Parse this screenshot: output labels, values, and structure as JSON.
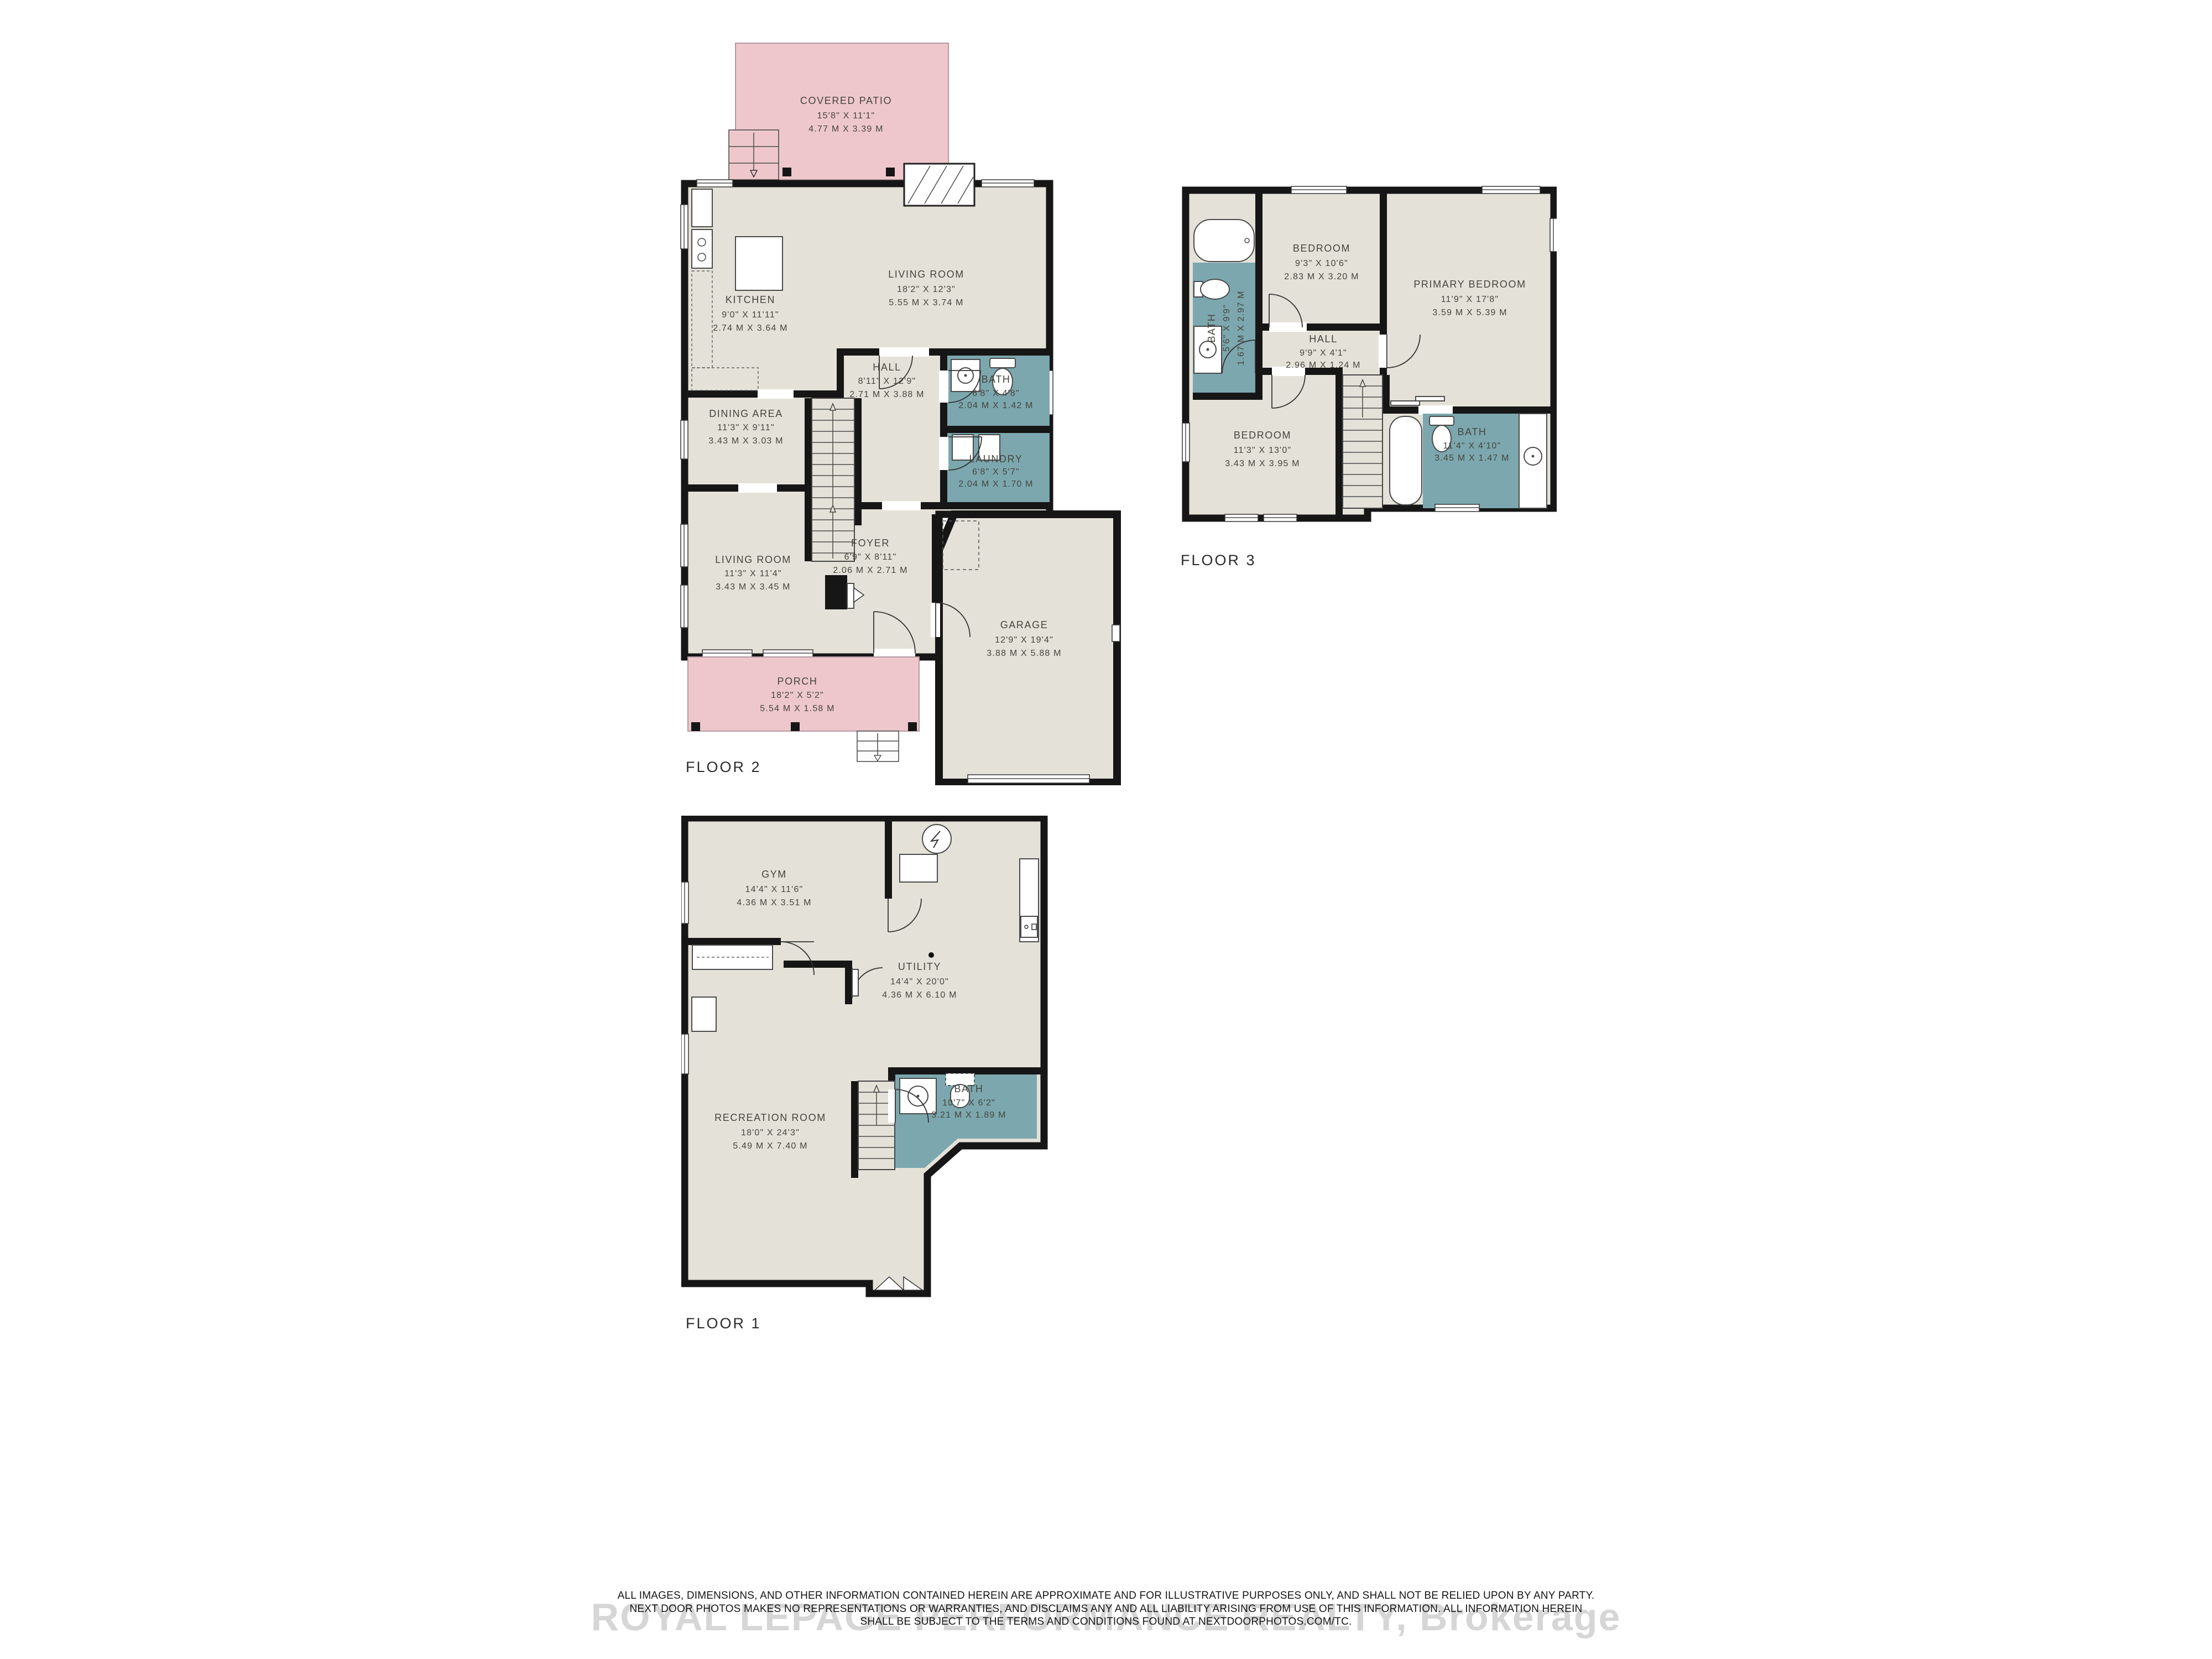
{
  "colors": {
    "room_fill": "#e4e2d8",
    "wet_fill": "#7ca7ae",
    "outdoor_fill": "#eec7cc",
    "wall": "#161616"
  },
  "floors": [
    {
      "label": "FLOOR 2",
      "rooms": [
        {
          "name": "COVERED PATIO",
          "ft": "15'8\" X 11'1\"",
          "m": "4.77 M X 3.39 M"
        },
        {
          "name": "KITCHEN",
          "ft": "9'0\" X 11'11\"",
          "m": "2.74 M X 3.64 M"
        },
        {
          "name": "LIVING ROOM",
          "ft": "18'2\" X 12'3\"",
          "m": "5.55 M X 3.74 M"
        },
        {
          "name": "HALL",
          "ft": "8'11\" X 12'9\"",
          "m": "2.71 M X 3.88 M"
        },
        {
          "name": "BATH",
          "ft": "6'8\" X 4'8\"",
          "m": "2.04 M X 1.42 M"
        },
        {
          "name": "DINING AREA",
          "ft": "11'3\" X 9'11\"",
          "m": "3.43 M X 3.03 M"
        },
        {
          "name": "LAUNDRY",
          "ft": "6'8\" X 5'7\"",
          "m": "2.04 M X 1.70 M"
        },
        {
          "name": "LIVING ROOM",
          "ft": "11'3\" X 11'4\"",
          "m": "3.43 M X 3.45 M"
        },
        {
          "name": "FOYER",
          "ft": "6'9\" X 8'11\"",
          "m": "2.06 M X 2.71 M"
        },
        {
          "name": "GARAGE",
          "ft": "12'9\" X 19'4\"",
          "m": "3.88 M X 5.88 M"
        },
        {
          "name": "PORCH",
          "ft": "18'2\" X 5'2\"",
          "m": "5.54 M X 1.58 M"
        }
      ]
    },
    {
      "label": "FLOOR 3",
      "rooms": [
        {
          "name": "BEDROOM",
          "ft": "9'3\" X 10'6\"",
          "m": "2.83 M X 3.20 M"
        },
        {
          "name": "PRIMARY BEDROOM",
          "ft": "11'9\" X 17'8\"",
          "m": "3.59 M X 5.39 M"
        },
        {
          "name": "BATH",
          "ft": "5'6\" X 9'9\"",
          "m": "1.67 M X 2.97 M"
        },
        {
          "name": "HALL",
          "ft": "9'9\" X 4'1\"",
          "m": "2.96 M X 1.24 M"
        },
        {
          "name": "BEDROOM",
          "ft": "11'3\" X 13'0\"",
          "m": "3.43 M X 3.95 M"
        },
        {
          "name": "BATH",
          "ft": "11'4\" X 4'10\"",
          "m": "3.45 M X 1.47 M"
        }
      ]
    },
    {
      "label": "FLOOR 1",
      "rooms": [
        {
          "name": "GYM",
          "ft": "14'4\" X 11'6\"",
          "m": "4.36 M X 3.51 M"
        },
        {
          "name": "UTILITY",
          "ft": "14'4\" X 20'0\"",
          "m": "4.36 M X 6.10 M"
        },
        {
          "name": "RECREATION ROOM",
          "ft": "18'0\" X 24'3\"",
          "m": "5.49 M X 7.40 M"
        },
        {
          "name": "BATH",
          "ft": "10'7\" X 6'2\"",
          "m": "3.21 M X 1.89 M"
        }
      ]
    }
  ],
  "watermark": "ROYAL LEPAGE PERFORMANCE REALTY, Brokerage",
  "disclaimer": {
    "line1": "ALL IMAGES, DIMENSIONS, AND OTHER INFORMATION CONTAINED HEREIN ARE APPROXIMATE AND FOR ILLUSTRATIVE PURPOSES ONLY, AND SHALL NOT BE RELIED UPON BY ANY PARTY.",
    "line2": "NEXT DOOR PHOTOS MAKES NO REPRESENTATIONS OR WARRANTIES, AND DISCLAIMS ANY AND ALL LIABILITY ARISING FROM USE OF THIS INFORMATION. ALL INFORMATION HEREIN",
    "line3": "SHALL BE SUBJECT TO THE TERMS AND CONDITIONS FOUND AT NEXTDOORPHOTOS.COM/TC."
  }
}
